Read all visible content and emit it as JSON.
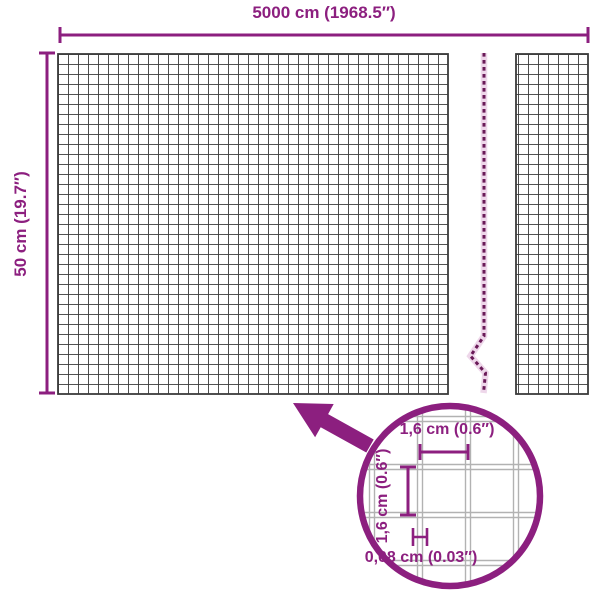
{
  "diagram": {
    "width_label": "5000 cm (1968.5″)",
    "height_label": "50 cm (19.7″)",
    "inset": {
      "mesh_width_label": "1,6 cm (0.6″)",
      "mesh_height_label": "1,6 cm (0.6″)",
      "wire_thickness_label": "0,08 cm (0.03″)"
    },
    "colors": {
      "accent": "#8c1f7f",
      "mesh_dark": "#3a3a3a",
      "mesh_light": "#b2b2b2",
      "break_dash": "#6a1a58",
      "break_halo": "#eed7ea",
      "background": "#ffffff"
    }
  }
}
